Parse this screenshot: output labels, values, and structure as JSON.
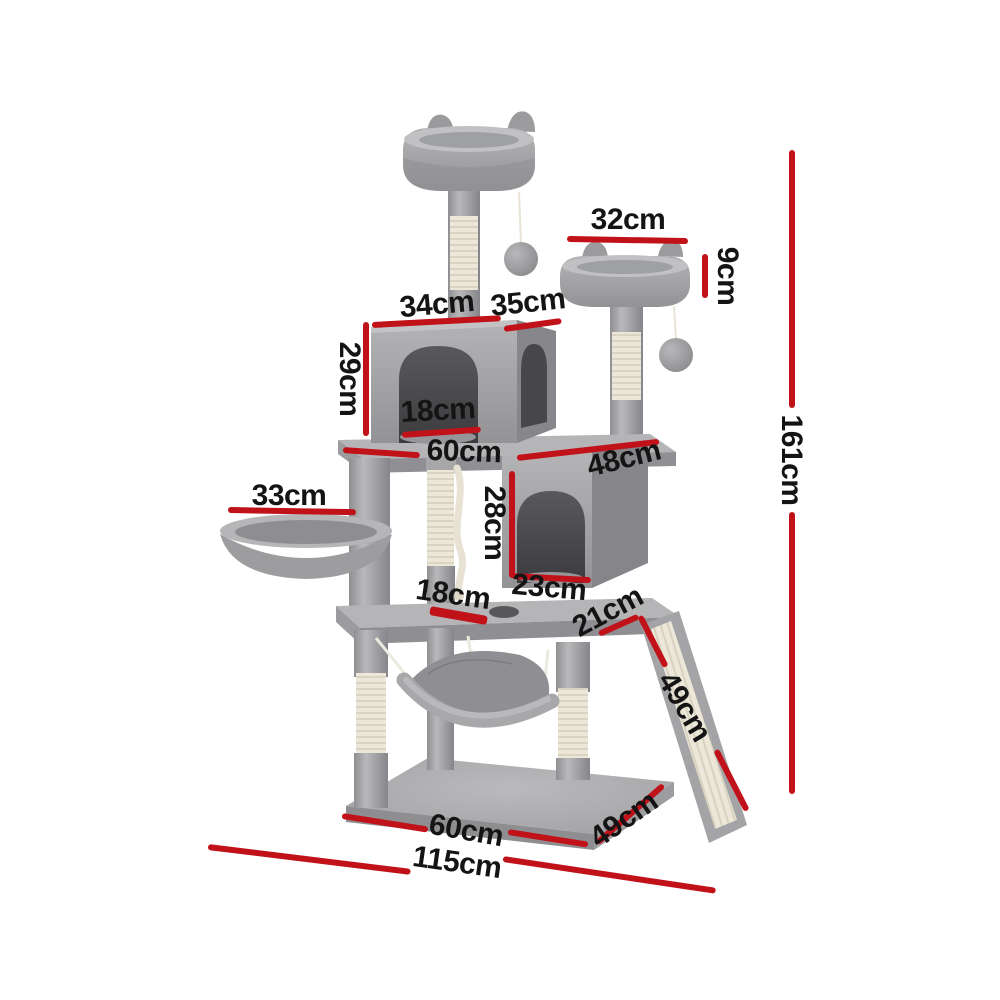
{
  "meta": {
    "image_type": "product dimension diagram",
    "subject": "grey plush cat tree tower with scratching posts, condos, perches, basket, hammock and ramp",
    "background": "#ffffff"
  },
  "palette": {
    "dimension_line_red": "#c1121a",
    "label_black": "#141414",
    "plush_grey": "#a3a3a6",
    "plush_shadow": "#87878a",
    "sisal_cream": "#ebe6d8",
    "cave_dark": "#47474b"
  },
  "dims": {
    "top_perch_width": {
      "label": "32cm"
    },
    "side_perch_height": {
      "label": "9cm"
    },
    "condo_top_width": {
      "label": "34cm"
    },
    "condo_top_depth": {
      "label": "35cm"
    },
    "condo_height": {
      "label": "29cm"
    },
    "condo_door_width": {
      "label": "18cm"
    },
    "mid_platform_width": {
      "label": "60cm"
    },
    "mid_platform_depth": {
      "label": "48cm"
    },
    "basket_width": {
      "label": "33cm"
    },
    "lower_condo_height": {
      "label": "28cm"
    },
    "lower_condo_door_width": {
      "label": "23cm"
    },
    "platform_hole_width": {
      "label": "18cm"
    },
    "ramp_top_width": {
      "label": "21cm"
    },
    "ramp_length": {
      "label": "49cm"
    },
    "overall_height": {
      "label": "161cm"
    },
    "base_width": {
      "label": "60cm"
    },
    "base_depth": {
      "label": "49cm"
    },
    "overall_width": {
      "label": "115cm"
    }
  }
}
